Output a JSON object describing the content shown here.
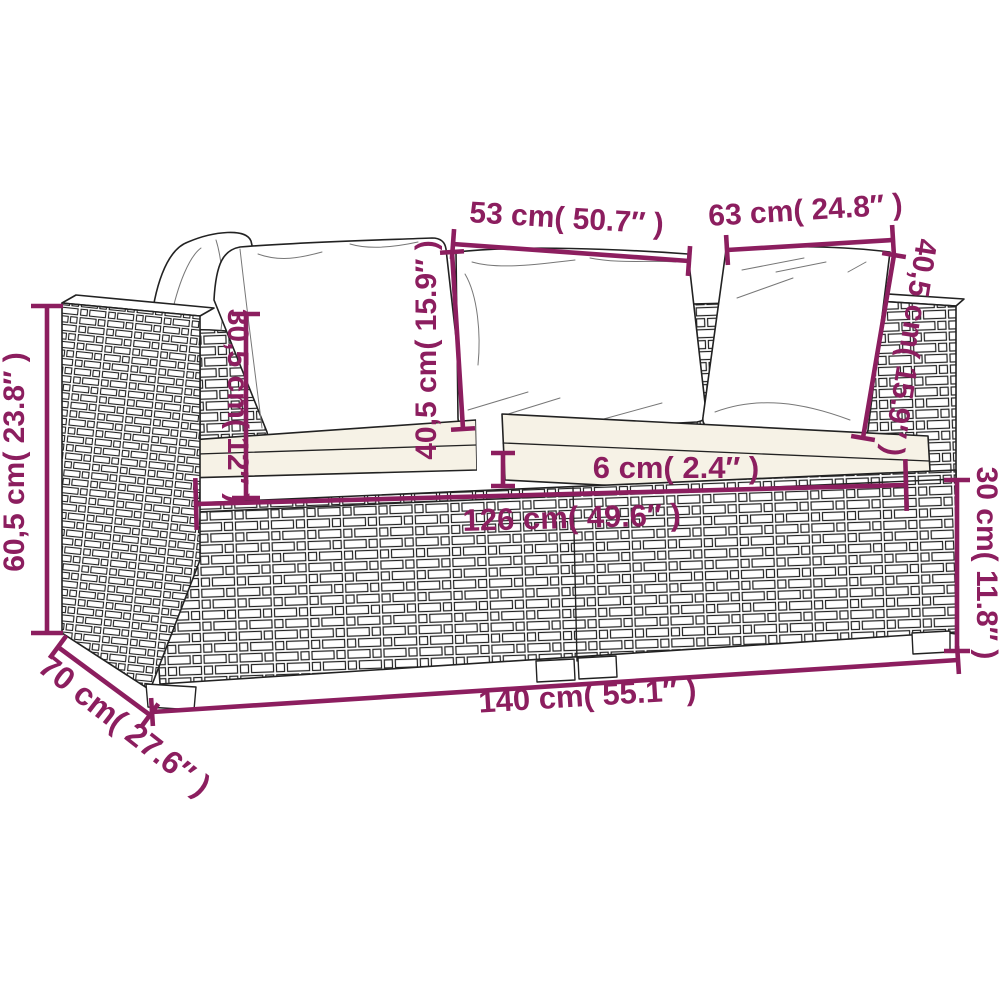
{
  "diagram": {
    "type": "product-dimension-diagram",
    "colors": {
      "dimension_line": "#8c1e5f",
      "line_art": "#222222",
      "pillow_fill": "#ffffff",
      "cushion_fill": "#f6f2e6",
      "background": "#ffffff"
    },
    "dimensions": [
      {
        "id": "left-back-cushion-width",
        "label": "53 cm( 50.7″ )",
        "line": {
          "x1": 453,
          "y1": 244,
          "x2": 689,
          "y2": 261
        },
        "tick": 30,
        "text": {
          "x": 566,
          "y": 228,
          "rotate": 3.5,
          "size": 30
        }
      },
      {
        "id": "right-back-cushion-width",
        "label": "63 cm( 24.8″ )",
        "line": {
          "x1": 727,
          "y1": 250,
          "x2": 893,
          "y2": 240
        },
        "tick": 30,
        "text": {
          "x": 806,
          "y": 220,
          "rotate": -3.5,
          "size": 30
        }
      },
      {
        "id": "center-back-cushion-height",
        "label": "40,5 cm( 15.9″ )",
        "line": {
          "x1": 452,
          "y1": 252,
          "x2": 463,
          "y2": 429
        },
        "tick": 24,
        "text": {
          "x": 436,
          "y": 350,
          "rotate": -90,
          "size": 30
        }
      },
      {
        "id": "left-back-cushion-height",
        "label": "30,5 cm( 12″ )",
        "line": {
          "x1": 246,
          "y1": 314,
          "x2": 246,
          "y2": 498
        },
        "tick": 28,
        "text": {
          "x": 228,
          "y": 406,
          "rotate": 90,
          "size": 30
        }
      },
      {
        "id": "armrest-height",
        "label": "60,5 cm( 23.8″ )",
        "line": {
          "x1": 47,
          "y1": 306,
          "x2": 47,
          "y2": 633
        },
        "tick": 32,
        "text": {
          "x": 24,
          "y": 462,
          "rotate": -90,
          "size": 30
        }
      },
      {
        "id": "cushion-gap",
        "label": "6 cm( 2.4″ )",
        "line": {
          "x1": 503,
          "y1": 453,
          "x2": 503,
          "y2": 486
        },
        "tick": 24,
        "text": {
          "x": 676,
          "y": 478,
          "rotate": 0,
          "size": 31
        }
      },
      {
        "id": "seat-width",
        "label": "126 cm( 49.6″ )",
        "line": {
          "x1": 196,
          "y1": 504,
          "x2": 906,
          "y2": 485
        },
        "tick": 52,
        "text": {
          "x": 572,
          "y": 528,
          "rotate": -1.5,
          "size": 31
        }
      },
      {
        "id": "right-back-cushion-height",
        "label": "40,5 cm( 15.9″ )",
        "line": {
          "x1": 894,
          "y1": 255,
          "x2": 863,
          "y2": 438
        },
        "tick": 24,
        "text": {
          "x": 900,
          "y": 346,
          "rotate": 99,
          "size": 30
        }
      },
      {
        "id": "base-height",
        "label": "30 cm( 11.8″ )",
        "line": {
          "x1": 957,
          "y1": 480,
          "x2": 957,
          "y2": 651
        },
        "tick": 26,
        "text": {
          "x": 977,
          "y": 563,
          "rotate": 90,
          "size": 30
        }
      },
      {
        "id": "total-width",
        "label": "140 cm( 55.1″ )",
        "line": {
          "x1": 152,
          "y1": 712,
          "x2": 958,
          "y2": 660
        },
        "tick": 28,
        "text": {
          "x": 588,
          "y": 706,
          "rotate": -3.5,
          "size": 31
        }
      },
      {
        "id": "depth",
        "label": "70 cm( 27.6″ )",
        "line": {
          "x1": 58,
          "y1": 647,
          "x2": 150,
          "y2": 715
        },
        "tick": 28,
        "text": {
          "x": 118,
          "y": 734,
          "rotate": 38,
          "size": 32
        }
      }
    ]
  }
}
